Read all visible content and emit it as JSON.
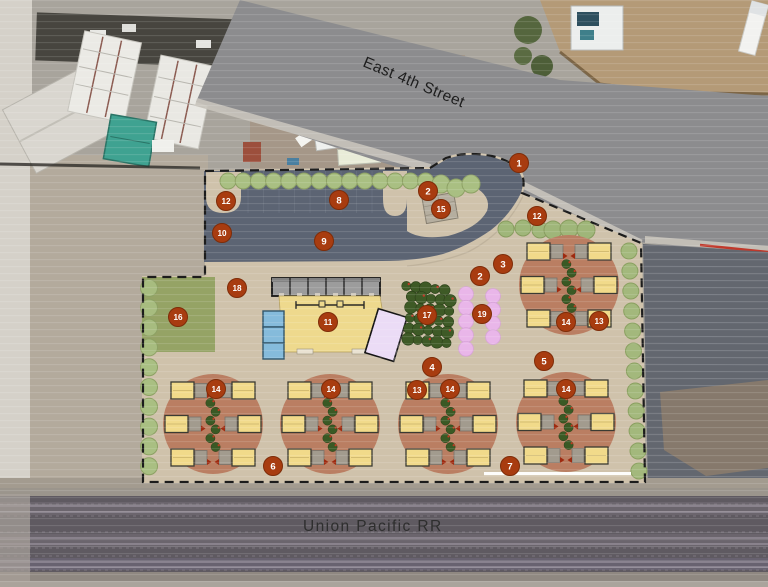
{
  "plan_labels": {
    "street": "East 4th Street",
    "railroad": "Union Pacific RR"
  },
  "markers": [
    {
      "label": "1",
      "x": 519,
      "y": 163
    },
    {
      "label": "2",
      "x": 428,
      "y": 191
    },
    {
      "label": "2",
      "x": 480,
      "y": 276
    },
    {
      "label": "3",
      "x": 503,
      "y": 264
    },
    {
      "label": "4",
      "x": 432,
      "y": 367
    },
    {
      "label": "5",
      "x": 544,
      "y": 361
    },
    {
      "label": "6",
      "x": 273,
      "y": 466
    },
    {
      "label": "7",
      "x": 510,
      "y": 466
    },
    {
      "label": "8",
      "x": 339,
      "y": 200
    },
    {
      "label": "9",
      "x": 324,
      "y": 241
    },
    {
      "label": "10",
      "x": 222,
      "y": 233
    },
    {
      "label": "11",
      "x": 328,
      "y": 322
    },
    {
      "label": "12",
      "x": 226,
      "y": 201
    },
    {
      "label": "12",
      "x": 537,
      "y": 216
    },
    {
      "label": "13",
      "x": 417,
      "y": 390
    },
    {
      "label": "13",
      "x": 599,
      "y": 321
    },
    {
      "label": "14",
      "x": 216,
      "y": 389
    },
    {
      "label": "14",
      "x": 331,
      "y": 389
    },
    {
      "label": "14",
      "x": 450,
      "y": 389
    },
    {
      "label": "14",
      "x": 566,
      "y": 389
    },
    {
      "label": "14",
      "x": 566,
      "y": 322
    },
    {
      "label": "15",
      "x": 441,
      "y": 209
    },
    {
      "label": "16",
      "x": 178,
      "y": 317
    },
    {
      "label": "17",
      "x": 427,
      "y": 315
    },
    {
      "label": "18",
      "x": 237,
      "y": 288
    },
    {
      "label": "19",
      "x": 482,
      "y": 314
    }
  ],
  "palette": {
    "marker_fill": "#a83c10",
    "marker_stroke": "#7e2c08",
    "marker_text": "#ffffff",
    "site_tan": "#cfc2ab",
    "parking_gray": "#5c6473",
    "cluster_terracotta": "#ba7e62",
    "unit_yellow": "#f1da8a",
    "patio_gray": "#a29b8e",
    "street_tree_green": "#a9bf82",
    "dark_tree_green": "#3a5924",
    "lawn_green": "#95a365",
    "orchard_green": "#3e5a26",
    "pink_tree": "#e9b6e9",
    "blue_unit": "#85bbdb",
    "lavender_unit": "#ebdcf6",
    "building_yellow": "#eed98d",
    "door_red": "#9e2a10"
  }
}
